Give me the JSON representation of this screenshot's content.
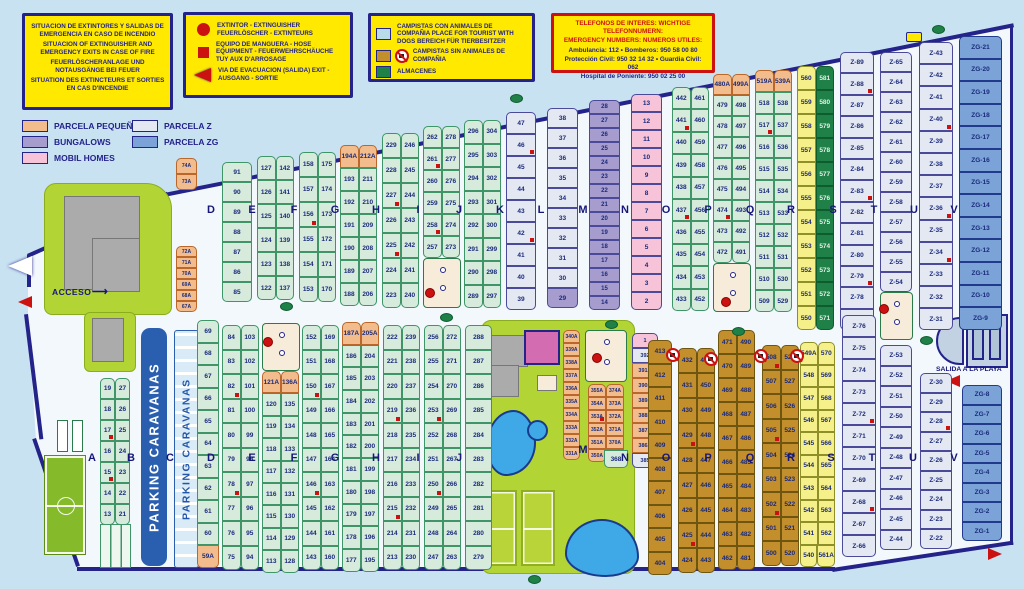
{
  "legend_boxes": {
    "fire": {
      "lines": [
        "SITUACION DE EXTINTORES Y SALIDAS DE EMERGENCIA EN CASO DE INCENDIO",
        "SITUACION OF EXTINGUISHER AND EMERGENCY EXITS IN CASE OF FIRE",
        "FEUERLÖSCHERANLAGE UND NOTAUSGÄNGE BEI FEUER",
        "SITUATION DES EXTINCTEURS ET SORTIES EN CAS D'INCENDIE"
      ]
    },
    "symbols": {
      "extintor": "EXTINTOR - EXTINGUISHER FEUERLÖSCHER - EXTINTEURS",
      "hose": "EQUIPO DE MANGUERA - HOSE EQUIPMENT - FEUERWEHRSCHÄUCHE TUY AUX D'ARROSAGE",
      "exit": "VIA DE EVACUACION (SALIDA) EXIT - AUSGANG - SORTIE"
    },
    "zones": {
      "dogs": "CAMPISTAS CON ANIMALES DE COMPAÑIA PLACE FOR TOURIST WITH DOGS BEREICH FÜR TIERBESITZER",
      "no_dogs": "CAMPISTAS SIN ANIMALES DE COMPAÑIA",
      "almacenes": "ALMACENES"
    },
    "phones": {
      "title1": "TELEFONOS DE INTERES:  WICHTIGE TELEFONNUMERN:",
      "title2": "EMERGENCY NUMBERS:  NUMEROS UTILES:",
      "lines": [
        "Ambulancia: 112 • Bomberos: 950 58 00 80",
        "Protección Civil: 950 32 14 32 • Guardia Civil: 062",
        "Hospital de Poniente: 950 02 25 00"
      ]
    }
  },
  "parcel_legend": [
    {
      "label": "PARCELA PEQUEÑA",
      "color": "#f2bc8d"
    },
    {
      "label": "BUNGALOWS",
      "color": "#a79cce"
    },
    {
      "label": "MOBIL HOMES",
      "color": "#f6c3d8"
    },
    {
      "label": "PARCELA Z",
      "color": "#e4e8f3"
    },
    {
      "label": "PARCELA ZG",
      "color": "#7ba3d8"
    }
  ],
  "labels": {
    "acceso": "ACCESO",
    "acceso_arrow": "⟶",
    "salida_playa": "SALIDA A LA PLAYA",
    "parking1": "PARKING CARAVANAS",
    "parking2": "P A R K I N G   C A R A V A N A S"
  },
  "colors": {
    "navy": "#23238a",
    "red": "#cc1111",
    "yellow": "#ffe900",
    "green_parcel": "#d6ebdc",
    "orange_parcel": "#f2bc8d",
    "z_parcel": "#e4e8f3",
    "zg_parcel": "#7ba3d8",
    "bungalow": "#a79cce",
    "mobilhome": "#f6c3d8",
    "no_dogs_zone": "#c28f2c",
    "almacenes": "#1f8048",
    "grass": "#b3d435",
    "pool": "#3fa9e8"
  },
  "area_labels": [
    {
      "t": "D",
      "x": 211,
      "y": 204
    },
    {
      "t": "E",
      "x": 252,
      "y": 204
    },
    {
      "t": "F",
      "x": 294,
      "y": 204
    },
    {
      "t": "G",
      "x": 335,
      "y": 204
    },
    {
      "t": "H",
      "x": 376,
      "y": 204
    },
    {
      "t": "I",
      "x": 418,
      "y": 204
    },
    {
      "t": "J",
      "x": 459,
      "y": 204
    },
    {
      "t": "K",
      "x": 500,
      "y": 204
    },
    {
      "t": "L",
      "x": 541,
      "y": 204
    },
    {
      "t": "M",
      "x": 583,
      "y": 204
    },
    {
      "t": "N",
      "x": 625,
      "y": 204
    },
    {
      "t": "O",
      "x": 666,
      "y": 204
    },
    {
      "t": "P",
      "x": 708,
      "y": 204
    },
    {
      "t": "Q",
      "x": 750,
      "y": 204
    },
    {
      "t": "R",
      "x": 791,
      "y": 204
    },
    {
      "t": "S",
      "x": 833,
      "y": 204
    },
    {
      "t": "T",
      "x": 874,
      "y": 204
    },
    {
      "t": "U",
      "x": 914,
      "y": 204
    },
    {
      "t": "V",
      "x": 954,
      "y": 204
    },
    {
      "t": "A",
      "x": 92,
      "y": 452
    },
    {
      "t": "B",
      "x": 131,
      "y": 452
    },
    {
      "t": "C",
      "x": 170,
      "y": 452
    },
    {
      "t": "D",
      "x": 211,
      "y": 452
    },
    {
      "t": "E",
      "x": 252,
      "y": 452
    },
    {
      "t": "F",
      "x": 294,
      "y": 452
    },
    {
      "t": "G",
      "x": 335,
      "y": 452
    },
    {
      "t": "H",
      "x": 376,
      "y": 452
    },
    {
      "t": "I",
      "x": 418,
      "y": 452
    },
    {
      "t": "J",
      "x": 459,
      "y": 452
    },
    {
      "t": "M",
      "x": 583,
      "y": 444
    },
    {
      "t": "N",
      "x": 625,
      "y": 452
    },
    {
      "t": "O",
      "x": 666,
      "y": 452
    },
    {
      "t": "P",
      "x": 708,
      "y": 452
    },
    {
      "t": "Q",
      "x": 750,
      "y": 452
    },
    {
      "t": "R",
      "x": 791,
      "y": 452
    },
    {
      "t": "S",
      "x": 831,
      "y": 452
    },
    {
      "t": "T",
      "x": 872,
      "y": 452
    },
    {
      "t": "U",
      "x": 913,
      "y": 452
    },
    {
      "t": "V",
      "x": 954,
      "y": 452
    }
  ],
  "columns": [
    {
      "id": "a-top",
      "x": 176,
      "y": 158,
      "w": 21,
      "h": 16,
      "c": "o",
      "fs": 5,
      "cells": [
        "74A",
        "73A"
      ]
    },
    {
      "id": "a-bottom",
      "x": 176,
      "y": 246,
      "w": 21,
      "h": 11,
      "c": "o",
      "fs": 5,
      "cells": [
        "72A",
        "71A",
        "70A",
        "69A",
        "68A",
        "67A"
      ]
    },
    {
      "id": "d-upper",
      "x": 222,
      "y": 162,
      "w": 30,
      "h": 20,
      "c": "g",
      "cells": [
        "91",
        "90",
        "89",
        "88",
        "87",
        "86",
        "85"
      ]
    },
    {
      "id": "e-upper",
      "x": 257,
      "y": 156,
      "w": 37,
      "h": 24,
      "c": "g",
      "cells": [
        "127|142",
        "126|141",
        "125|140",
        "124|139",
        "123|138",
        "122|137"
      ]
    },
    {
      "id": "f-upper",
      "x": 299,
      "y": 152,
      "w": 37,
      "h": 25,
      "c": "g",
      "cells": [
        "158|175",
        "157|174",
        "156*|173",
        "155|172",
        "154|171",
        "153|170"
      ]
    },
    {
      "id": "g-upper",
      "x": 340,
      "y": 145,
      "w": 37,
      "h": 23,
      "c": "g",
      "cells": [
        "194A^o|212A^o",
        "193|211",
        "192|210",
        "191|209",
        "190|208",
        "189|207",
        "188|206"
      ]
    },
    {
      "id": "h-upper",
      "x": 382,
      "y": 133,
      "w": 37,
      "h": 25,
      "c": "g",
      "cells": [
        "229|246",
        "228|245",
        "227*|244",
        "226|243",
        "225*|242",
        "224|241",
        "223|240"
      ]
    },
    {
      "id": "i-upper",
      "x": 423,
      "y": 126,
      "w": 37,
      "h": 22,
      "c": "g",
      "cells": [
        "262|278",
        "261*|277",
        "260|276",
        "259|275",
        "258*|274",
        "257|273"
      ]
    },
    {
      "id": "j-upper",
      "x": 464,
      "y": 120,
      "w": 37,
      "h": 23.5,
      "c": "g",
      "cells": [
        "296|304",
        "295|303",
        "294|302",
        "293|301",
        "292|300",
        "291|299",
        "290|298",
        "289|297"
      ]
    },
    {
      "id": "k-upper",
      "x": 506,
      "y": 112,
      "w": 30,
      "h": 22,
      "c": "z",
      "cells": [
        "47",
        "46*",
        "45",
        "44",
        "43",
        "42*",
        "41",
        "40",
        "39"
      ]
    },
    {
      "id": "l-upper",
      "x": 547,
      "y": 108,
      "w": 31,
      "h": 20,
      "c": "z",
      "cells": [
        "38",
        "37",
        "36",
        "35",
        "34",
        "33",
        "32",
        "31",
        "30",
        "29^p"
      ]
    },
    {
      "id": "m-upper",
      "x": 589,
      "y": 100,
      "w": 31,
      "h": 14,
      "c": "p",
      "fs": 6,
      "cells": [
        "28",
        "27",
        "26",
        "25",
        "24",
        "23",
        "22",
        "21",
        "20",
        "19",
        "18",
        "17",
        "16",
        "15",
        "14"
      ]
    },
    {
      "id": "n-upper",
      "x": 631,
      "y": 94,
      "w": 31,
      "h": 18,
      "c": "k",
      "cells": [
        "13",
        "12",
        "11",
        "10",
        "9",
        "8",
        "7",
        "6",
        "5",
        "4",
        "3",
        "2"
      ]
    },
    {
      "id": "o-upper",
      "x": 672,
      "y": 87,
      "w": 37,
      "h": 22.4,
      "c": "g",
      "cells": [
        "442|461",
        "441*|460",
        "440|459",
        "439|458",
        "438|457",
        "437*|456",
        "436|455",
        "435|454",
        "434|453",
        "433|452"
      ]
    },
    {
      "id": "p-upper",
      "x": 713,
      "y": 74,
      "w": 37,
      "h": 21,
      "c": "g",
      "cells": [
        "480A^o|499A^o",
        "479|498",
        "478|497",
        "477|496",
        "476|495",
        "475|494",
        "474*|493",
        "473|492",
        "472|491"
      ]
    },
    {
      "id": "q-upper",
      "x": 755,
      "y": 70,
      "w": 37,
      "h": 22,
      "c": "g",
      "cells": [
        "519A^o|539A^o",
        "518|538",
        "517*|537",
        "516|536",
        "515|535",
        "514|534",
        "513|533",
        "512|532",
        "511|531",
        "510|530",
        "509|529"
      ]
    },
    {
      "id": "r-upper",
      "x": 797,
      "y": 66,
      "w": 37,
      "h": 24,
      "c": "ye",
      "cells": [
        "560|581^dg",
        "559|580^dg",
        "558|579^dg",
        "557|578^dg",
        "556|577^dg",
        "555|576^dg",
        "554|575^dg",
        "553|574^dg",
        "552|573^dg",
        "551|572^dg",
        "550|571^dg"
      ]
    },
    {
      "id": "st-upper",
      "x": 840,
      "y": 52,
      "w": 34,
      "h": 21.4,
      "c": "z",
      "cells": [
        "Z-89",
        "Z-88*",
        "Z-87",
        "Z-86",
        "Z-85",
        "Z-84",
        "Z-83*",
        "Z-82",
        "Z-81",
        "Z-80",
        "Z-79*",
        "Z-78",
        "Z-77"
      ]
    },
    {
      "id": "tu-upper",
      "x": 880,
      "y": 52,
      "w": 32,
      "h": 20,
      "c": "z",
      "cells": [
        "Z-65",
        "Z-64",
        "Z-63",
        "Z-62",
        "Z-61",
        "Z-60",
        "Z-59",
        "Z-58",
        "Z-57",
        "Z-56",
        "Z-55",
        "Z-54"
      ]
    },
    {
      "id": "uv-upper",
      "x": 919,
      "y": 42,
      "w": 34,
      "h": 22.2,
      "c": "z",
      "cells": [
        "Z-43",
        "Z-42",
        "Z-41",
        "Z-40*",
        "Z-39",
        "Z-38",
        "Z-37",
        "Z-36*",
        "Z-35",
        "Z-34*",
        "Z-33",
        "Z-32",
        "Z-31"
      ]
    },
    {
      "id": "zg-upper",
      "x": 959,
      "y": 36,
      "w": 43,
      "h": 22.6,
      "c": "zg",
      "cells": [
        "ZG-21",
        "ZG-20",
        "ZG-19",
        "ZG-18",
        "ZG-17",
        "ZG-16",
        "ZG-15",
        "ZG-14",
        "ZG-13",
        "ZG-12",
        "ZG-11",
        "ZG-10",
        "ZG-9"
      ]
    },
    {
      "id": "ab-lower",
      "x": 100,
      "y": 378,
      "w": 30,
      "h": 21,
      "c": "g",
      "cells": [
        "19|27",
        "18|26",
        "17*|25",
        "16|24",
        "15*|23",
        "14|22",
        "13|21"
      ]
    },
    {
      "id": "cd-lower",
      "x": 197,
      "y": 320,
      "w": 22,
      "h": 22.5,
      "c": "g",
      "cells": [
        "69",
        "68",
        "67",
        "66",
        "65",
        "64",
        "63",
        "62",
        "61",
        "60",
        "59A^o"
      ]
    },
    {
      "id": "de-lower",
      "x": 222,
      "y": 325,
      "w": 37,
      "h": 24.5,
      "c": "g",
      "cells": [
        "84|103",
        "83|102",
        "82*|101",
        "81|100",
        "80|99",
        "79|98",
        "78*|97",
        "77|96",
        "76|95",
        "75|94"
      ]
    },
    {
      "id": "ef-lower",
      "x": 262,
      "y": 371,
      "w": 37,
      "h": 22.4,
      "c": "g",
      "cells": [
        "121A^o|136A^o",
        "120|135",
        "119|134",
        "118|133",
        "117|132",
        "116|131",
        "115|130",
        "114|129",
        "113|128"
      ]
    },
    {
      "id": "fg-lower",
      "x": 302,
      "y": 325,
      "w": 37,
      "h": 24.5,
      "c": "g",
      "cells": [
        "152|169",
        "151|168",
        "150*|167",
        "149|166",
        "148|165",
        "147|164",
        "146*|163",
        "145|162",
        "144|161",
        "143|160"
      ]
    },
    {
      "id": "gh-lower",
      "x": 342,
      "y": 322,
      "w": 37,
      "h": 22.7,
      "c": "g",
      "cells": [
        "187A^o|205A^o",
        "186|204",
        "185|203",
        "184|202",
        "183|201",
        "182|200",
        "181|199",
        "180|198",
        "179|197",
        "178|196",
        "177|195"
      ]
    },
    {
      "id": "hi-lower",
      "x": 383,
      "y": 325,
      "w": 37,
      "h": 24.5,
      "c": "g",
      "cells": [
        "222|239",
        "221|238",
        "220|237",
        "219*|236",
        "218|235",
        "217|234",
        "216|233",
        "215*|232",
        "214|231",
        "213|230"
      ]
    },
    {
      "id": "ij-lower",
      "x": 424,
      "y": 325,
      "w": 37,
      "h": 24.5,
      "c": "g",
      "cells": [
        "256|272",
        "255|271",
        "254|270",
        "253*|269",
        "252|268",
        "251|267",
        "250*|266",
        "249|265",
        "248|264",
        "247|263"
      ]
    },
    {
      "id": "jk-lower",
      "x": 465,
      "y": 325,
      "w": 27,
      "h": 24.5,
      "c": "g",
      "cells": [
        "288",
        "287",
        "286",
        "285",
        "284",
        "283",
        "282",
        "281",
        "280",
        "279"
      ]
    },
    {
      "id": "m-a-col",
      "x": 563,
      "y": 330,
      "w": 17,
      "h": 13,
      "c": "o",
      "fs": 5,
      "cells": [
        "340A",
        "339A",
        "338A",
        "337A",
        "336A",
        "335A",
        "334A",
        "333A",
        "332A",
        "331A"
      ]
    },
    {
      "id": "m-pairs",
      "x": 588,
      "y": 384,
      "w": 36,
      "h": 13,
      "c": "o",
      "fs": 5,
      "cells": [
        "355A|374A",
        "354A|373A",
        "353A*|372A",
        "352A|371A",
        "351A|370A",
        "350A|369A"
      ]
    },
    {
      "id": "n-lower",
      "x": 632,
      "y": 333,
      "w": 26,
      "h": 15,
      "c": "o",
      "fs": 5.5,
      "cells": [
        "1^k",
        "392^z",
        "391A",
        "390A",
        "389A",
        "388A",
        "387A",
        "386A",
        "385^z"
      ]
    },
    {
      "id": "n368",
      "x": 604,
      "y": 450,
      "w": 24,
      "h": 18,
      "c": "g",
      "cells": [
        "368"
      ]
    },
    {
      "id": "o413-lower",
      "x": 648,
      "y": 340,
      "w": 24,
      "h": 23.5,
      "c": "br",
      "cells": [
        "413",
        "412",
        "411",
        "410",
        "409",
        "408",
        "407",
        "406",
        "405",
        "404"
      ]
    },
    {
      "id": "op-lower",
      "x": 678,
      "y": 348,
      "w": 37,
      "h": 25,
      "c": "br",
      "cells": [
        "432|451",
        "431|450",
        "430|449",
        "429*|448",
        "428|447",
        "427|446",
        "426|445",
        "425*|444",
        "424|443"
      ]
    },
    {
      "id": "pq-lower",
      "x": 718,
      "y": 330,
      "w": 37,
      "h": 24,
      "c": "br",
      "cells": [
        "471|490",
        "470|489",
        "469|488",
        "468|487",
        "467|486",
        "466|485",
        "465|484",
        "464|483",
        "463|482",
        "462|481"
      ]
    },
    {
      "id": "qr-lower",
      "x": 762,
      "y": 345,
      "w": 37,
      "h": 24.5,
      "c": "br",
      "cells": [
        "508*|528",
        "507|527",
        "506|526",
        "505*|525",
        "504|524",
        "503|523",
        "502*|522",
        "501|521",
        "500|520"
      ]
    },
    {
      "id": "rs-lower",
      "x": 800,
      "y": 342,
      "w": 35,
      "h": 22.5,
      "c": "ye",
      "cells": [
        "549A|570",
        "548|569",
        "547|568",
        "546|567",
        "545|566",
        "544|565",
        "543|564",
        "542|563",
        "541|562",
        "540|561A"
      ]
    },
    {
      "id": "st-lower",
      "x": 842,
      "y": 315,
      "w": 34,
      "h": 22,
      "c": "z",
      "cells": [
        "Z-76",
        "Z-75",
        "Z-74",
        "Z-73",
        "Z-72*",
        "Z-71",
        "Z-70",
        "Z-69",
        "Z-68*",
        "Z-67",
        "Z-66"
      ]
    },
    {
      "id": "tu-lower",
      "x": 880,
      "y": 345,
      "w": 32,
      "h": 20.5,
      "c": "z",
      "cells": [
        "Z-53",
        "Z-52",
        "Z-51",
        "Z-50",
        "Z-49",
        "Z-48",
        "Z-47",
        "Z-46",
        "Z-45",
        "Z-44"
      ]
    },
    {
      "id": "uv-lower",
      "x": 920,
      "y": 373,
      "w": 32,
      "h": 19.5,
      "c": "z",
      "cells": [
        "Z-30",
        "Z-29",
        "Z-28*",
        "Z-27",
        "Z-26",
        "Z-25",
        "Z-24",
        "Z-23",
        "Z-22"
      ]
    },
    {
      "id": "zg-lower",
      "x": 962,
      "y": 385,
      "w": 40,
      "h": 19.5,
      "c": "zg",
      "cells": [
        "ZG-8",
        "ZG-7",
        "ZG-6",
        "ZG-5",
        "ZG-4",
        "ZG-3",
        "ZG-2",
        "ZG-1"
      ]
    }
  ],
  "features": {
    "trees": [
      [
        510,
        94
      ],
      [
        280,
        302
      ],
      [
        440,
        313
      ],
      [
        605,
        320
      ],
      [
        732,
        327
      ],
      [
        920,
        336
      ],
      [
        528,
        575
      ],
      [
        932,
        25
      ]
    ],
    "extinguishers": [
      [
        263,
        337
      ],
      [
        425,
        288
      ],
      [
        592,
        353
      ],
      [
        721,
        297
      ],
      [
        879,
        304
      ]
    ],
    "no_dogs_icons": [
      [
        666,
        348
      ],
      [
        704,
        352
      ],
      [
        754,
        349
      ],
      [
        790,
        349
      ]
    ]
  }
}
